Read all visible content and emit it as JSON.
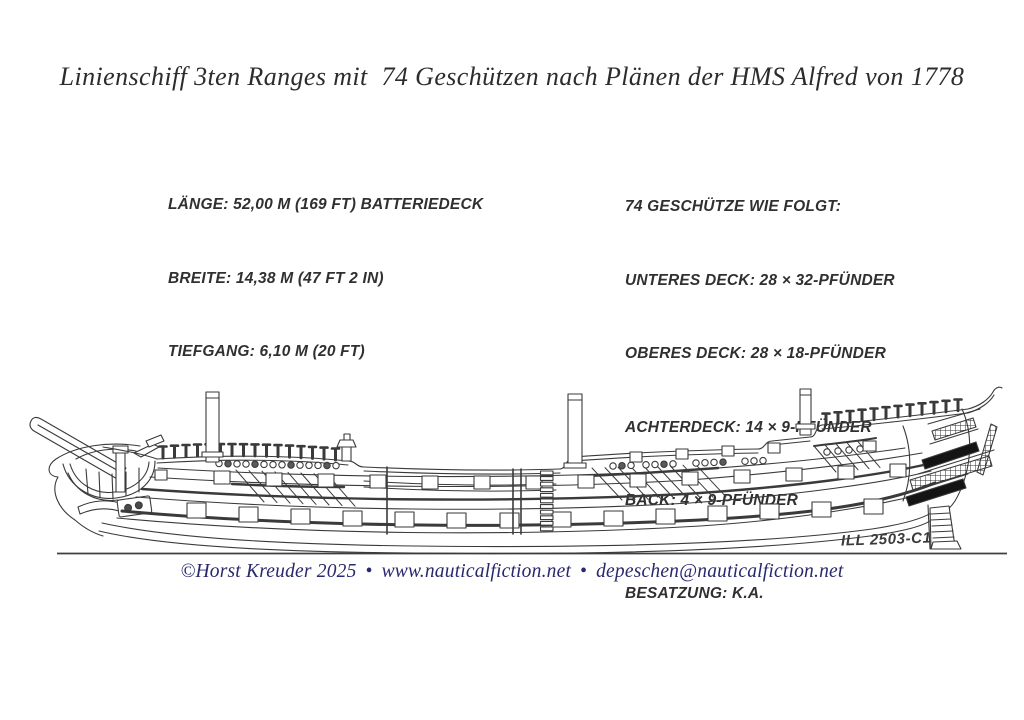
{
  "title": "Linienschiff 3ten Ranges mit  74 Geschützen nach Plänen der HMS Alfred von 1778",
  "dimensions": {
    "length": "LÄNGE: 52,00 M (169 FT) BATTERIEDECK",
    "beam": "BREITE: 14,38 M (47 FT 2 IN)",
    "draft": "TIEFGANG: 6,10 M (20 FT)"
  },
  "armament": {
    "heading": "74 GESCHÜTZE WIE FOLGT:",
    "lower_deck": "UNTERES DECK: 28 × 32-PFÜNDER",
    "upper_deck": "OBERES DECK: 28 × 18-PFÜNDER",
    "quarterdeck": "ACHTERDECK: 14 × 9-PFÜNDER",
    "forecastle": "BACK: 4 × 9-PFÜNDER",
    "crew": "BESATZUNG: K.A."
  },
  "illustration": {
    "id_label": "ILL 2503-C1"
  },
  "footer": {
    "copyright": "©Horst Kreuder 2025",
    "separator": "•",
    "website": "www.nauticalfiction.net",
    "email": "depeschen@nauticalfiction.net"
  },
  "colors": {
    "ink": "#3a3a3a",
    "text_dark": "#2d2d2d",
    "footer_navy": "#28286E"
  }
}
